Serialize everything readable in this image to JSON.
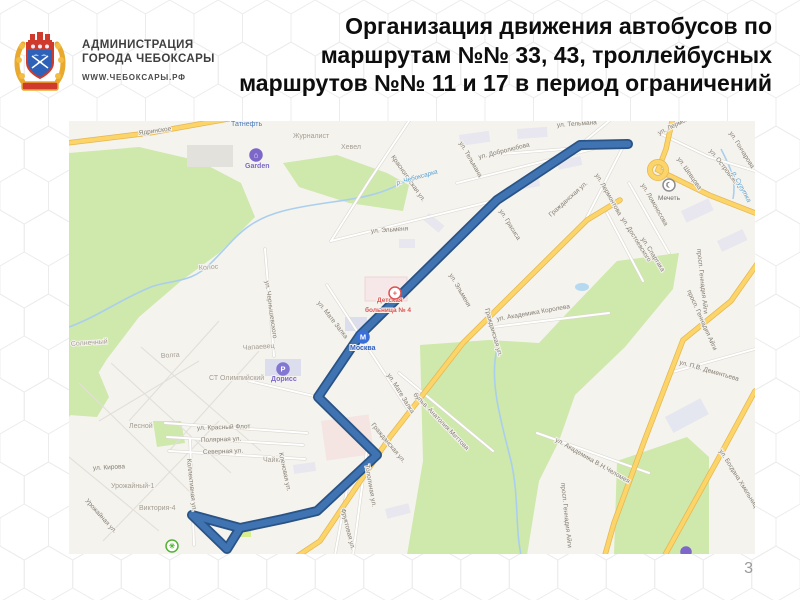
{
  "page": {
    "number": "3"
  },
  "header": {
    "admin": {
      "line1": "АДМИНИСТРАЦИЯ",
      "line2": "ГОРОДА ЧЕБОКСАРЫ",
      "url": "WWW.ЧЕБОКСАРЫ.РФ"
    },
    "title": {
      "line1": "Организация движения автобусов по",
      "line2": "маршрутам №№ 33, 43, троллейбусных",
      "line3": "маршрутов №№ 11 и 17 в период ограничений"
    }
  },
  "map": {
    "palette": {
      "land": "#f5f3ee",
      "green": "#cfe8ab",
      "water": "#aacfee",
      "road_yellow": "#fbd46a",
      "road_yellow_edge": "#e6b650",
      "route_fill": "#3f73b2",
      "route_edge": "#2a5385"
    },
    "route": {
      "description": "bus/trolleybus route line",
      "points": [
        [
          559,
          23
        ],
        [
          511,
          24
        ],
        [
          428,
          79
        ],
        [
          291,
          214
        ],
        [
          249,
          276
        ],
        [
          308,
          334
        ],
        [
          248,
          390
        ],
        [
          214,
          398
        ],
        [
          171,
          407
        ],
        [
          123,
          394
        ],
        [
          158,
          428
        ],
        [
          171,
          407
        ]
      ]
    },
    "labels": [
      {
        "t": "Ядринское",
        "x": 70,
        "y": 14,
        "r": -8,
        "c": "s"
      },
      {
        "t": "Татнефть",
        "x": 162,
        "y": 5,
        "r": 0,
        "c": "tat"
      },
      {
        "t": "Журналист",
        "x": 224,
        "y": 17,
        "r": 0,
        "c": "a"
      },
      {
        "t": "Хевел",
        "x": 272,
        "y": 28,
        "r": 0,
        "c": "a"
      },
      {
        "t": "Красногорская ул.",
        "x": 322,
        "y": 36,
        "r": 55,
        "c": "s"
      },
      {
        "t": "Garden",
        "x": 176,
        "y": 47,
        "r": 0,
        "c": "purple"
      },
      {
        "t": "р. Чебоксарка",
        "x": 328,
        "y": 64,
        "r": -16,
        "c": "w"
      },
      {
        "t": "ул. Тельмана",
        "x": 488,
        "y": 6,
        "r": -4,
        "c": "s"
      },
      {
        "t": "ул. Тельмана",
        "x": 390,
        "y": 22,
        "r": 60,
        "c": "s"
      },
      {
        "t": "ул. Добролюбова",
        "x": 410,
        "y": 38,
        "r": -14,
        "c": "s"
      },
      {
        "t": "ул. Грасиса",
        "x": 430,
        "y": 90,
        "r": 58,
        "c": "s"
      },
      {
        "t": "ул. Лермонтова",
        "x": 526,
        "y": 54,
        "r": 60,
        "c": "s"
      },
      {
        "t": "ул. Лермонтова",
        "x": 590,
        "y": 14,
        "r": -26,
        "c": "s"
      },
      {
        "t": "ул. Шевцова",
        "x": 608,
        "y": 38,
        "r": 55,
        "c": "s"
      },
      {
        "t": "ул. Островского",
        "x": 640,
        "y": 30,
        "r": 52,
        "c": "s"
      },
      {
        "t": "ул. Гончарова",
        "x": 660,
        "y": 12,
        "r": 58,
        "c": "s"
      },
      {
        "t": "ул. Ломоносова",
        "x": 572,
        "y": 64,
        "r": 60,
        "c": "s"
      },
      {
        "t": "Мечеть",
        "x": 589,
        "y": 79,
        "r": 0,
        "c": "dark"
      },
      {
        "t": "р. Сугутка",
        "x": 663,
        "y": 52,
        "r": 62,
        "c": "w"
      },
      {
        "t": "ул. Достоевского",
        "x": 552,
        "y": 98,
        "r": 58,
        "c": "s"
      },
      {
        "t": "ул. Спартака",
        "x": 572,
        "y": 118,
        "r": 58,
        "c": "s"
      },
      {
        "t": "Гражданская ул.",
        "x": 482,
        "y": 96,
        "r": -42,
        "c": "s"
      },
      {
        "t": "Гражданская ул.",
        "x": 416,
        "y": 188,
        "r": 74,
        "c": "s"
      },
      {
        "t": "Гражданская ул.",
        "x": 302,
        "y": 304,
        "r": 50,
        "c": "s"
      },
      {
        "t": "ул. Академика Королева",
        "x": 428,
        "y": 200,
        "r": -10,
        "c": "s"
      },
      {
        "t": "ул. Эльменя",
        "x": 302,
        "y": 112,
        "r": -4,
        "c": "s"
      },
      {
        "t": "ул. Эльменя",
        "x": 380,
        "y": 154,
        "r": 60,
        "c": "s"
      },
      {
        "t": "ул. Чернышевского",
        "x": 196,
        "y": 160,
        "r": 82,
        "c": "s"
      },
      {
        "t": "ул. Мате Залка",
        "x": 248,
        "y": 182,
        "r": 52,
        "c": "s"
      },
      {
        "t": "ул. Мате Залка",
        "x": 318,
        "y": 254,
        "r": 58,
        "c": "s"
      },
      {
        "t": "Колос",
        "x": 130,
        "y": 149,
        "r": -4,
        "c": "a"
      },
      {
        "t": "Солнечный",
        "x": 2,
        "y": 225,
        "r": -4,
        "c": "a"
      },
      {
        "t": "Волга",
        "x": 92,
        "y": 237,
        "r": -4,
        "c": "a"
      },
      {
        "t": "Чапаевец",
        "x": 174,
        "y": 229,
        "r": -4,
        "c": "a"
      },
      {
        "t": "СТ Олимпийский",
        "x": 140,
        "y": 259,
        "r": 0,
        "c": "a"
      },
      {
        "t": "Дорисс",
        "x": 202,
        "y": 260,
        "r": 0,
        "c": "purple"
      },
      {
        "t": "Лесной",
        "x": 60,
        "y": 307,
        "r": 0,
        "c": "a"
      },
      {
        "t": "ул. Красный Флот",
        "x": 128,
        "y": 309,
        "r": -2,
        "c": "s"
      },
      {
        "t": "Полярная ул.",
        "x": 132,
        "y": 321,
        "r": -2,
        "c": "s"
      },
      {
        "t": "Северная ул.",
        "x": 134,
        "y": 333,
        "r": -2,
        "c": "s"
      },
      {
        "t": "Чайка",
        "x": 194,
        "y": 341,
        "r": 0,
        "c": "a"
      },
      {
        "t": "Кленовая ул.",
        "x": 210,
        "y": 332,
        "r": 78,
        "c": "s"
      },
      {
        "t": "ул. Кирова",
        "x": 24,
        "y": 349,
        "r": -3,
        "c": "s"
      },
      {
        "t": "Урожайный-1",
        "x": 42,
        "y": 367,
        "r": 0,
        "c": "a"
      },
      {
        "t": "Урожайная ул.",
        "x": 16,
        "y": 380,
        "r": 48,
        "c": "s"
      },
      {
        "t": "Виктория-4",
        "x": 70,
        "y": 389,
        "r": 0,
        "c": "a"
      },
      {
        "t": "Коллективная ул.",
        "x": 118,
        "y": 338,
        "r": 84,
        "c": "s"
      },
      {
        "t": "Тополиная ул.",
        "x": 296,
        "y": 344,
        "r": 80,
        "c": "s"
      },
      {
        "t": "Фруктовая ул.",
        "x": 272,
        "y": 388,
        "r": 76,
        "c": "s"
      },
      {
        "t": "бульв. Анатолия Миттова",
        "x": 344,
        "y": 274,
        "r": 46,
        "c": "s"
      },
      {
        "t": "ул. Академика В.Н.Челомея",
        "x": 486,
        "y": 320,
        "r": 30,
        "c": "s"
      },
      {
        "t": "просп. Геннадия Айги",
        "x": 618,
        "y": 170,
        "r": 66,
        "c": "s"
      },
      {
        "t": "просп. Геннадия Айги",
        "x": 628,
        "y": 128,
        "r": 84,
        "c": "s"
      },
      {
        "t": "просп. Геннадия Айги",
        "x": 492,
        "y": 362,
        "r": 84,
        "c": "s"
      },
      {
        "t": "ул. П.В. Дементьева",
        "x": 610,
        "y": 243,
        "r": 16,
        "c": "s"
      },
      {
        "t": "ул. Богдана Хмельницкого",
        "x": 650,
        "y": 330,
        "r": 58,
        "c": "s"
      },
      {
        "t": "Детская",
        "x": 308,
        "y": 181,
        "r": 0,
        "c": "red"
      },
      {
        "t": "больница № 4",
        "x": 296,
        "y": 191,
        "r": 0,
        "c": "red"
      },
      {
        "t": "Москва",
        "x": 281,
        "y": 229,
        "r": 0,
        "c": "blue"
      }
    ],
    "pois": [
      {
        "name": "garden-icon",
        "x": 187,
        "y": 34,
        "rad": 6,
        "bg": "#7d68c9",
        "stroke": "#7d68c9",
        "glyph": "⌂",
        "fg": "#ffffff"
      },
      {
        "name": "parking-doriss-icon",
        "x": 214,
        "y": 248,
        "rad": 6,
        "bg": "#8377d1",
        "stroke": "#8377d1",
        "glyph": "P",
        "fg": "#ffffff"
      },
      {
        "name": "hospital-cross-icon",
        "x": 326,
        "y": 172,
        "rad": 6,
        "bg": "#ffffff",
        "stroke": "#e05050",
        "glyph": "+",
        "fg": "#e05050"
      },
      {
        "name": "mall-moskva-icon",
        "x": 294,
        "y": 216,
        "rad": 6,
        "bg": "#3a6fd8",
        "stroke": "#3a6fd8",
        "glyph": "М",
        "fg": "#ffffff"
      },
      {
        "name": "mosque-icon",
        "x": 600,
        "y": 64,
        "rad": 6,
        "bg": "#ffffff",
        "stroke": "#8d8d8d",
        "glyph": "☾",
        "fg": "#777777"
      },
      {
        "name": "bus-terminus-icon",
        "x": 103,
        "y": 425,
        "rad": 6,
        "bg": "#ffffff",
        "stroke": "#54b335",
        "glyph": "✳",
        "fg": "#54b335"
      },
      {
        "name": "poi-icon",
        "x": 617,
        "y": 431,
        "rad": 5,
        "bg": "#7d68c9",
        "stroke": "#7d68c9",
        "glyph": "",
        "fg": "#ffffff"
      }
    ]
  }
}
